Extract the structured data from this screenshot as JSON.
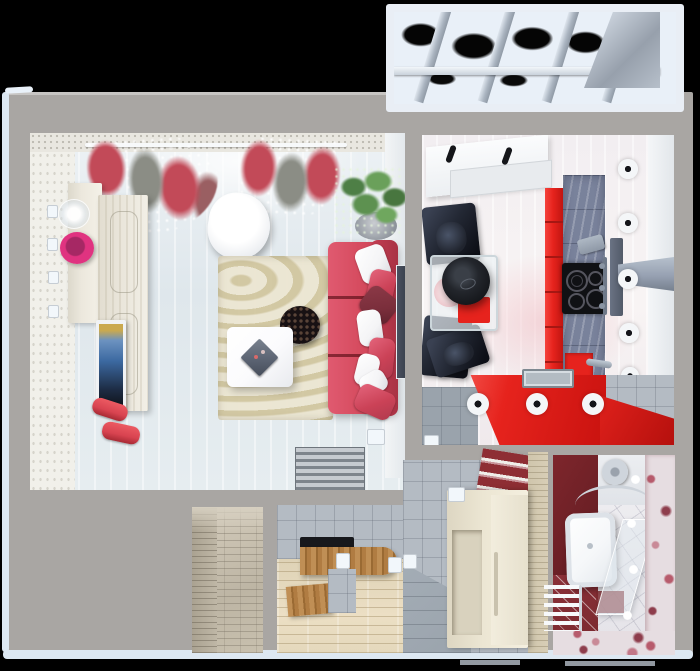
{
  "scene": {
    "type": "3d-floorplan-top-down-render",
    "subject": "one-bedroom apartment with red and white interior",
    "background": "black"
  },
  "colors": {
    "bg": "#000000",
    "wall_gray": "#a9a6a3",
    "edge_blue": "#dde8f2",
    "living_floor": "#e3eaee",
    "wallpaper": "#f1f0ea",
    "ceiling_band": "#e9e7e0",
    "curtain_red": "#c24a58",
    "sofa_red": "#d4495c",
    "sofa_red_light": "#cb4257",
    "pillow_dark": "#7a2e3b",
    "pillow_white": "#f4f4f6",
    "rug_beige": "#dcd3b4",
    "table_white": "#fbfbfd",
    "side_table_black": "#181113",
    "tv_blue": "#3c69a1",
    "vase_pink": "#e03380",
    "bolster_red": "#d84350",
    "cabinet_cream": "#ece8dd",
    "kitchen_floor": "#f6f1f2",
    "kitchen_red": "#e6231d",
    "stone_blue": "#79829b",
    "cooktop_black": "#101114",
    "hood_gray": "#97a1b2",
    "chair_dark": "#232834",
    "light_white": "#f4f6f8",
    "sink_gray": "#b3bcc3",
    "hall_wood": "#e7ddc5",
    "bench_wood": "#b9854a",
    "bench_top_black": "#17181c",
    "tile_gray": "#b4bbc3",
    "tile_gray_dark": "#9aa3ac",
    "cream_cabinet": "#ece6d3",
    "slat_red": "#8e2e34",
    "travertine": "#d8ceb6",
    "corridor_stone": "#c8c0ae",
    "bath_red": "#6d2026",
    "bath_floor": "#e9e8ec",
    "floral_pink": "#b75b6c",
    "tub_white": "#f5f7f9",
    "radiator_red": "#7c2a30",
    "glass_blue": "#e9f0f8",
    "strut_gray": "#aab4c0",
    "panel_gray": "#97a0ac"
  },
  "rooms": {
    "living_room": {
      "label": "living-room",
      "furniture": [
        "red-lace-curtains",
        "curtain-rod",
        "sideboard",
        "tall-cabinet",
        "glass-vase",
        "pink-vase",
        "wall-tv",
        "red-bolster",
        "red-bolster",
        "white-armchair",
        "potted-plant",
        "wavy-rug",
        "red-sofa",
        "sofa-pillows",
        "white-coffee-table",
        "gray-tablet",
        "black-side-table",
        "striped-doormat",
        "dark-wall-panel",
        "wall-sconces",
        "floor-switch"
      ]
    },
    "kitchen": {
      "label": "kitchen",
      "furniture": [
        "ceiling-light-panel",
        "panel-handles",
        "dining-table",
        "black-pendant-lamp",
        "pink-plate",
        "red-tray",
        "dining-chairs",
        "red-cabinet-column",
        "stone-counter-wall",
        "red-backsplash",
        "cooktop",
        "grater",
        "range-hood",
        "chrome-fixture",
        "red-counter",
        "sink",
        "faucet",
        "ceiling-spotlights",
        "gray-floor-mat",
        "tile-corner"
      ]
    },
    "balcony": {
      "label": "glazed-balcony",
      "furniture": [
        "glass-roof-panels",
        "roof-struts",
        "cross-bar",
        "corner-panel"
      ]
    },
    "corridor": {
      "label": "entry-corridor",
      "furniture": [
        "stone-tile-walls",
        "stone-tile-floor"
      ]
    },
    "hallway": {
      "label": "hallway",
      "furniture": [
        "tile-wall",
        "wood-plank-floor",
        "wooden-bench",
        "black-bench-top",
        "wood-step-box",
        "tile-block",
        "shoe-cabinet",
        "red-slat-wall-cabinet",
        "travertine-wall",
        "gray-floor-mat",
        "wall-sconces"
      ]
    },
    "bathroom": {
      "label": "bathroom",
      "furniture": [
        "dark-red-wall",
        "shower-head",
        "shower-rail",
        "glass-shower-screen",
        "bathtub",
        "towel-radiator",
        "red-floor-tiles",
        "floral-tile-wall",
        "floral-tile-border",
        "ceiling-spotlights"
      ]
    }
  }
}
